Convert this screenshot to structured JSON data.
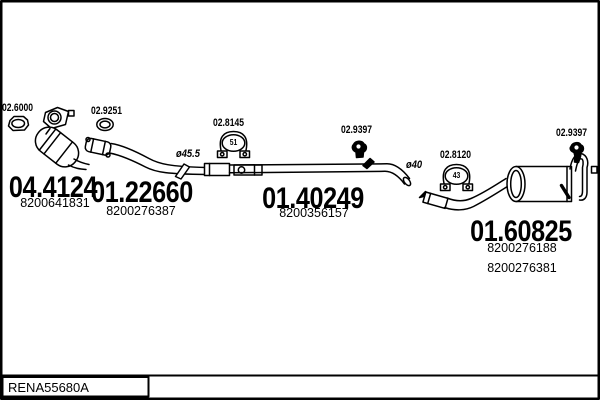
{
  "diagram": {
    "kind": "exhaust-system-parts-diagram",
    "code": "RENA55680A",
    "colors": {
      "line": "#000000",
      "background": "#ffffff"
    },
    "parts": {
      "gasket_front": {
        "ref": "02.6000"
      },
      "catalyst": {
        "ref": "04.4124",
        "oe1": "8200641831"
      },
      "gasket_mid": {
        "ref": "02.9251"
      },
      "front_pipe": {
        "ref": "01.22660",
        "oe1": "8200276387",
        "diameter": "ø45.5"
      },
      "clamp_front": {
        "ref": "02.8145",
        "size": "51"
      },
      "centre_pipe": {
        "ref": "01.40249",
        "oe1": "8200356157",
        "diameter": "ø40"
      },
      "hanger_centre": {
        "ref": "02.9397"
      },
      "clamp_rear": {
        "ref": "02.8120",
        "size": "43"
      },
      "rear_silencer": {
        "ref": "01.60825",
        "oe1": "8200276188",
        "oe2": "8200276381"
      },
      "hanger_rear": {
        "ref": "02.9397"
      }
    }
  }
}
